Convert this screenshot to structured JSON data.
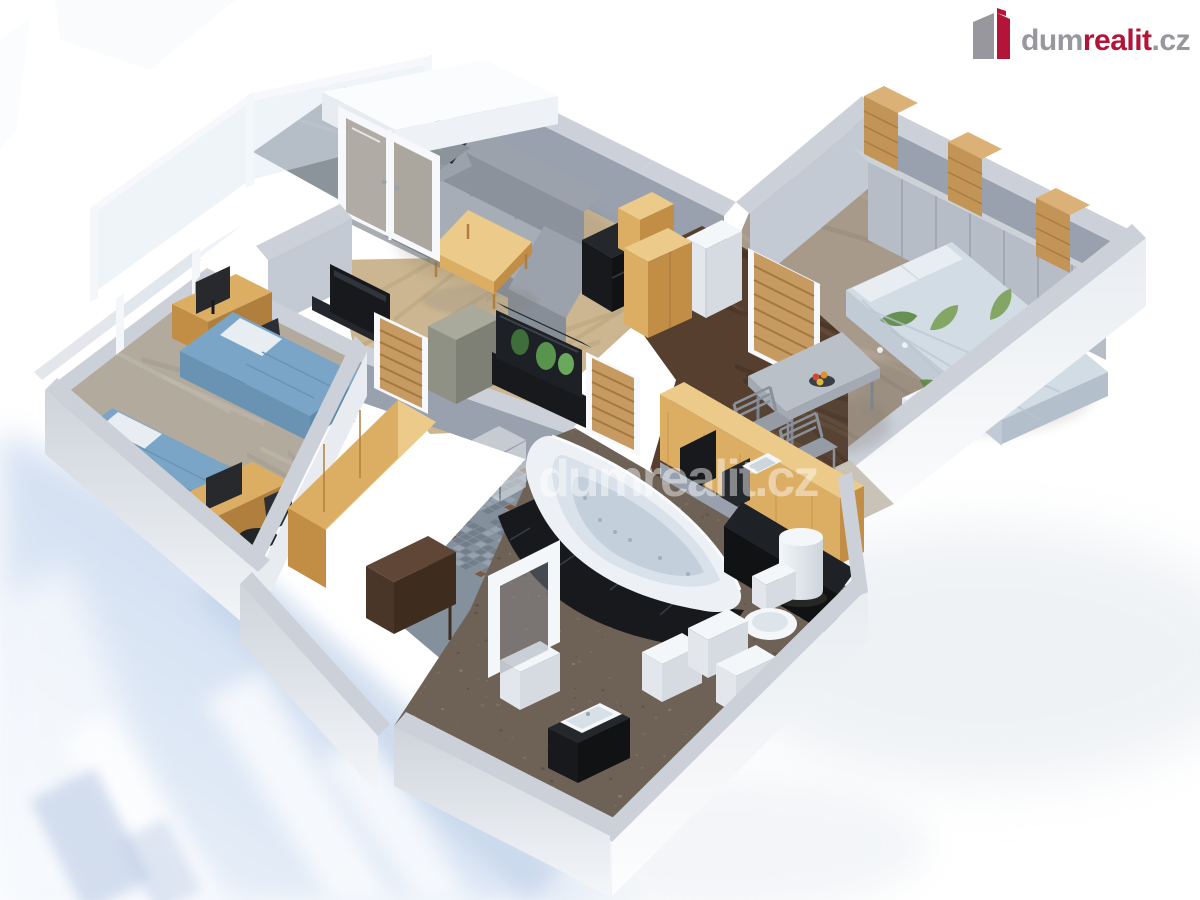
{
  "header": {
    "logo": {
      "icon": "dumrealit-building-icon",
      "text_part_gray1": "dum",
      "text_part_red": "realit",
      "text_part_gray2": ".cz"
    }
  },
  "watermark": {
    "icon": "dumrealit-building-icon",
    "text": "dumrealit.cz",
    "opacity": 0.45
  },
  "scene": {
    "type": "3d-floorplan-render",
    "rooms": [
      {
        "name": "living-room",
        "furniture": [
          "corner-sofa",
          "coffee-table",
          "media-unit",
          "tv",
          "aquarium",
          "oak-cabinets",
          "french-doors"
        ]
      },
      {
        "name": "balcony",
        "furniture": [
          "glass-railing",
          "tiled-floor"
        ]
      },
      {
        "name": "children-room",
        "furniture": [
          "bed-1",
          "bed-2",
          "desk-1",
          "desk-2",
          "office-chairs",
          "monitors",
          "tilted-windows",
          "oak-wardrobe"
        ]
      },
      {
        "name": "master-bedroom",
        "furniture": [
          "double-bed-floral",
          "wardrobe-row",
          "wood-shelf-towers",
          "nightstand",
          "window-sills",
          "slatted-door"
        ]
      },
      {
        "name": "hallway-kitchen",
        "furniture": [
          "dark-wood-floor",
          "fridge",
          "kitchen-counter",
          "cooktop",
          "dining-table",
          "chairs",
          "fruit-bowl",
          "slatted-doors"
        ]
      },
      {
        "name": "bathroom",
        "furniture": [
          "corner-jacuzzi",
          "black-tile-apron",
          "black-counter",
          "water-heater",
          "toilet",
          "washing-machines",
          "sink-vanity",
          "door-frame",
          "mosaic-floor"
        ]
      }
    ],
    "palette": {
      "wallTop": "#ccd1d9",
      "wallIn": "#98a1ad",
      "wallInL": "#c3cad3",
      "wallOut": "#e8ecf0",
      "white": "#f4f7fa",
      "whiteSh": "#e3e7ec",
      "whiteSh2": "#d6dbe2",
      "glass": "#dfeaf3",
      "glassFrame": "#f6f8fb",
      "oakTop": "#eccb8a",
      "oak": "#dcae64",
      "oakDk": "#c28d45",
      "oakDeep": "#b07f3e",
      "oakDoor": "#c69a60",
      "oakSlat": "#a2793f",
      "floorLiv": "#cbb691",
      "livS1": "#dbc8a3",
      "livS2": "#b7a27b",
      "floorKid": "#b2ab9d",
      "kidS1": "#c0bab0",
      "kidS2": "#a0988a",
      "floorMas": "#a79a8b",
      "masS1": "#b6a99b",
      "masS2": "#94877a",
      "floorHall": "#563f2f",
      "hallS1": "#6d5340",
      "hallS2": "#452f22",
      "floorBath": "#6e6156",
      "bathD1": "#7e7065",
      "bathD2": "#5c4f44",
      "bathD3": "#8f8071",
      "mosaic": "#85909d",
      "mosA": "#737e8b",
      "mosB": "#98a2ae",
      "mosC": "#7b5a44",
      "marble": "#c9c2b6",
      "sofa": "#9ba2ac",
      "sofaL": "#a7adb6",
      "sofaD": "#8b929c",
      "sofaD2": "#868e98",
      "blue": "#7ba5c6",
      "blueD": "#6a93b3",
      "blueD2": "#5f89a9",
      "pillow": "#e8edf2",
      "floral": "#d2dce5",
      "floralD": "#b9c6d2",
      "floralS1": "#c0cbd5",
      "floralS2": "#b3bfca",
      "leaf": "#7aa057",
      "leafD": "#5d8743",
      "black": "#17191d",
      "black2": "#24272c",
      "black3": "#101214",
      "blackHi": "#2f353b",
      "grayCab": "#a9aa9c",
      "grayCabD": "#8f9184",
      "grayCabD2": "#7e8076",
      "wrdFront": "#b6bdc7",
      "wrdTop": "#cdd2d8",
      "wrdSeam": "#9aa2ae",
      "tableTop": "#b9c0c8",
      "tableEdge": "#a3aab4",
      "chair": "#959ca6",
      "chairD": "#8a919b",
      "tub": "#edf1f5",
      "tubIn": "#d9e2ea",
      "tubIn2": "#c3d0dc",
      "tubRim": "#fafcfe",
      "tubJet": "#9fb0bf",
      "woodTower": "#dcb177",
      "woodTowerD": "#c29455",
      "brownDesk": "#5f4637",
      "brownDeskD": "#4a3628",
      "brownDeskD2": "#3e2d1e",
      "shadowBlue": "#c9d8ee",
      "shadowBlue2": "#b9cce6",
      "shadowCorner": "#a9bdde",
      "slabA": "#ced4db",
      "slabB": "#f4f6f9",
      "outA": "#e9edf1",
      "outB": "#fdfdfe",
      "shA": "#c9d8ee",
      "shB": "#eef4fb",
      "cylA": "#f3f6f9",
      "cylB": "#cdd4db",
      "fruitRed": "#cf4a30",
      "fruitOrange": "#e0912f",
      "fruitYellow": "#d9b93c",
      "logoGray": "#97979d",
      "logoRed": "#b41437",
      "wmWhite": "#ffffff"
    }
  }
}
